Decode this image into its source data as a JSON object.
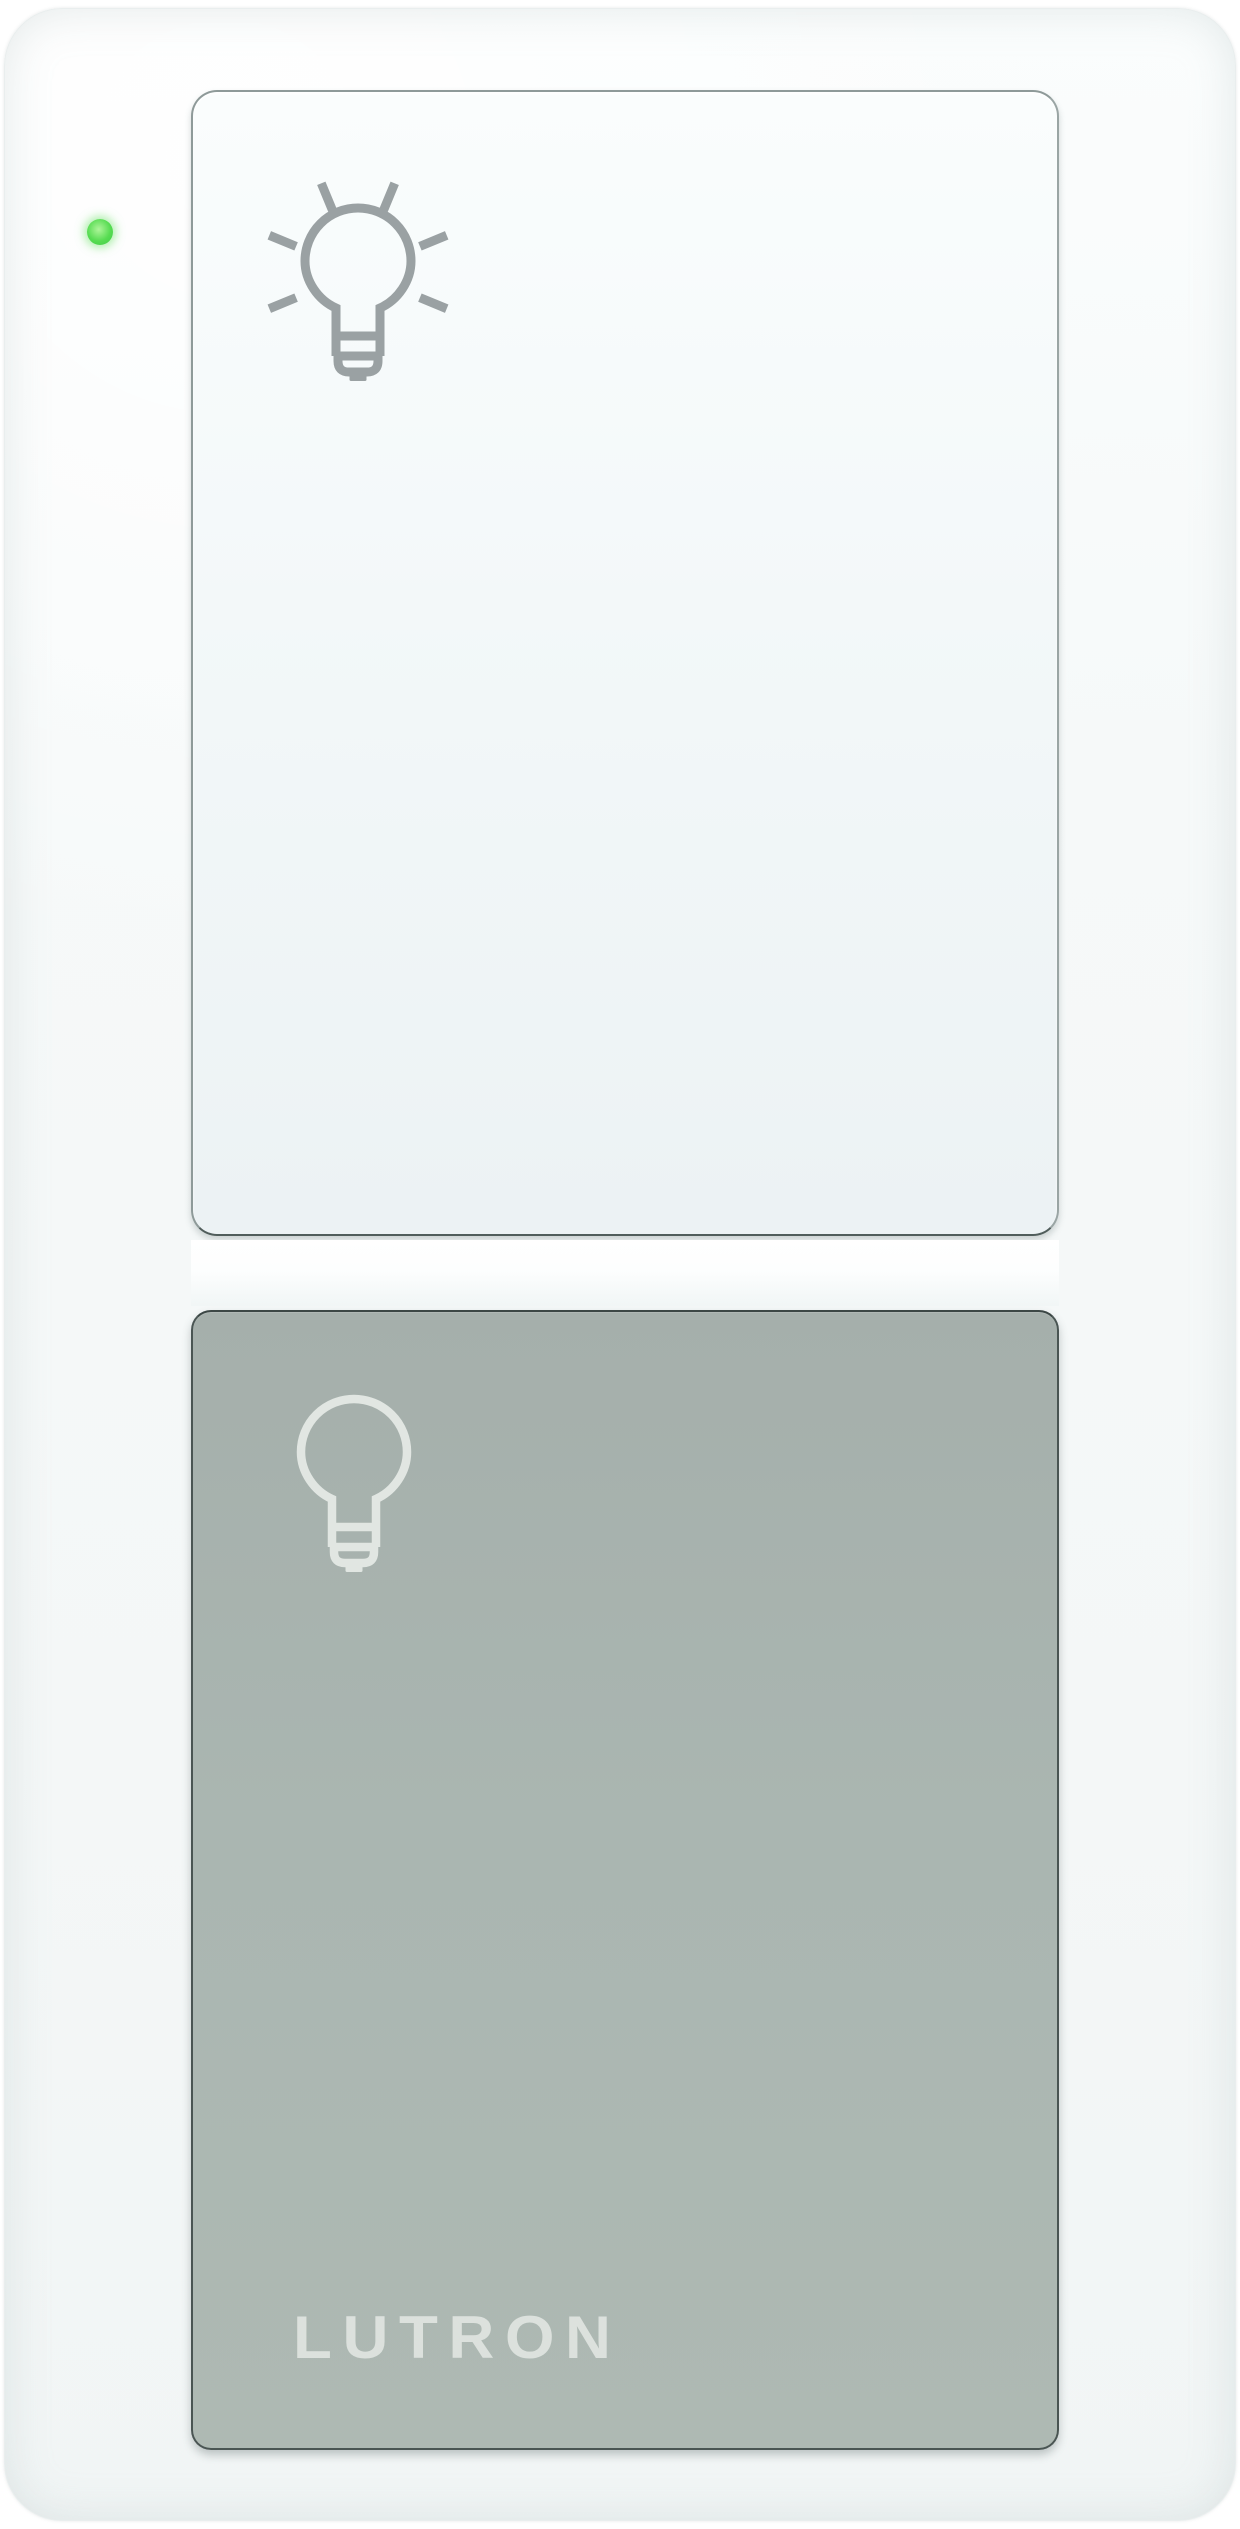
{
  "device": {
    "brand_label": "LUTRON",
    "led": {
      "state": "on",
      "color": "#57dc52"
    },
    "buttons": [
      {
        "id": "light-on",
        "icon": "light-bulb-on-icon",
        "surface": "white"
      },
      {
        "id": "light-off",
        "icon": "light-bulb-off-icon",
        "surface": "gray"
      }
    ]
  },
  "colors": {
    "led_green": "#57dc52",
    "button_off_gray": "#aab6b1",
    "icon_gray": "#9aa1a3",
    "icon_off_white": "#e1e6e2",
    "brand_text": "#dce1dd",
    "outline_dark": "#4a5553"
  }
}
